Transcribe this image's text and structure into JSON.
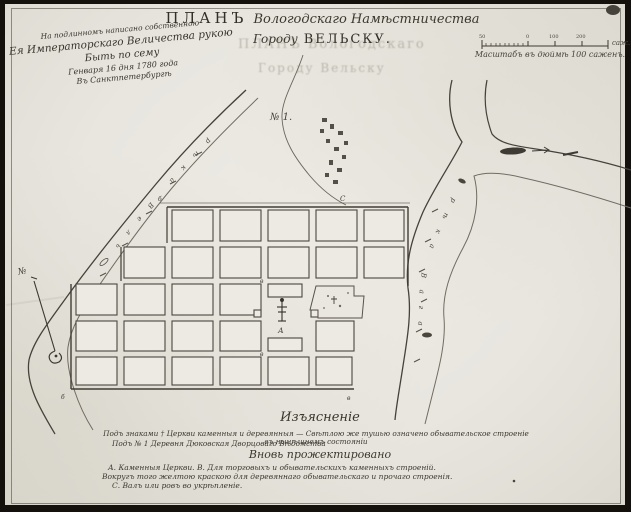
{
  "title": {
    "word_plan": "ПЛАНЪ",
    "line1_rest": "Вологодскаго Намѣстничества",
    "line2_word": "Городу",
    "line2_city": "ВЕЛЬСКУ."
  },
  "ghost": {
    "line1": "ПЛАНЪ Вологодскаго",
    "line2": "Городу Вельску"
  },
  "approval": {
    "line1": "На подлинномъ написано собственною",
    "line2": "Ея Императорскаго Величества рукою",
    "line3": "Быть по сему",
    "line4": "Генваря 16 дня 1780 года",
    "line5": "Въ Санктпетербургѣ"
  },
  "scale": {
    "caption": "Масштабъ въ дюймѣ 100 саженъ.",
    "unit": "саж.",
    "tick_labels": [
      "50",
      "0",
      "100",
      "200"
    ]
  },
  "compass": {
    "north_mark": "№"
  },
  "map": {
    "no1_label": "№ 1.",
    "left_river_name": "рѣка Вель",
    "right_river_name": "рѣка Вага",
    "church_letter": "А",
    "block_letter_top": "в",
    "block_letter_bottom": "в",
    "corner_ne": "С",
    "corner_nw": "б",
    "corner_sw": "б",
    "corner_se": "в",
    "oldtown_cross": "†"
  },
  "legend": {
    "heading": "Изъясненіе",
    "line1": "Подъ знаками † Церкви каменныя и деревянныя — Свѣтлою же тушью означено обывательское строеніе въ нынѣшнемъ состояніи",
    "line2": "Подъ № 1 Деревня Дюковская Дворцоваго Вѣдомства",
    "subhead": "Вновь прожектировано",
    "line3": "А. Каменныя Церкви. В. Для торговыхъ и обывательскихъ каменныхъ строеній.",
    "line4": "Вокругъ того желтою краскою для деревяннаго обывательскаго и прочаго строенія.",
    "line5": "С. Валъ или ровъ во укрѣпленіе."
  }
}
